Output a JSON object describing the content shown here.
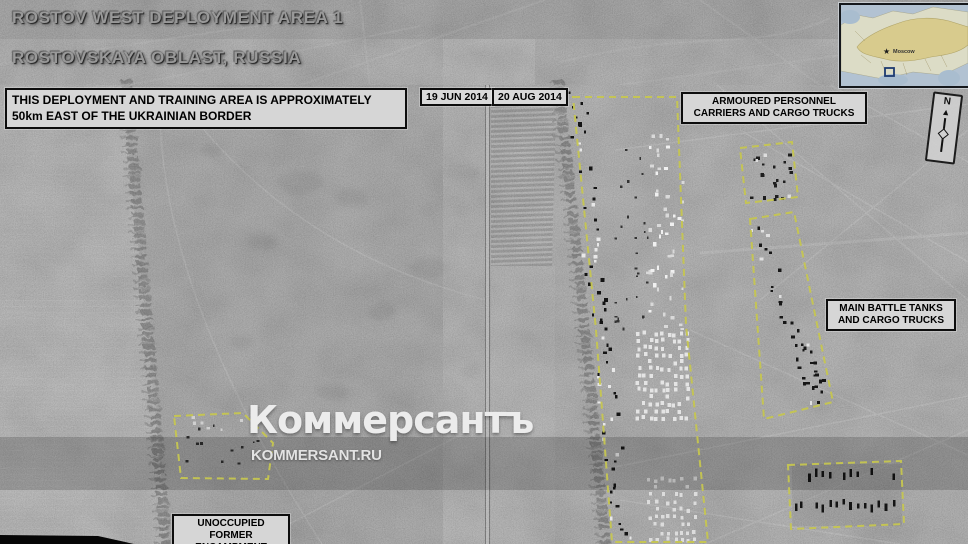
{
  "header": {
    "title_line1": "ROSTOV WEST DEPLOYMENT AREA 1",
    "title_line2": "ROSTOVSKAYA OBLAST, RUSSIA",
    "info_text": "THIS DEPLOYMENT AND TRAINING AREA IS APPROXIMATELY 50km EAST OF THE UKRAINIAN BORDER"
  },
  "panels": {
    "left_date": "19 JUN 2014",
    "right_date": "20 AUG 2014"
  },
  "annotations": {
    "apc_label": "ARMOURED PERSONNEL CARRIERS AND CARGO TRUCKS",
    "tanks_label": "MAIN BATTLE TANKS AND CARGO TRUCKS",
    "encampment_label": "UNOCCUPIED FORMER ENCAMPMENT"
  },
  "watermark": {
    "logo": "Коммерсантъ",
    "url": "KOMMERSANT.RU"
  },
  "inset_map": {
    "city_label": "Moscow"
  },
  "compass": {
    "north_label": "N"
  },
  "colors": {
    "annotation_yellow": "#c6c650",
    "label_bg": "#d6d6d6",
    "map_land_russia": "#d8cb8d",
    "map_land_other": "#dcdcc6",
    "map_water": "#b2c2d2"
  }
}
